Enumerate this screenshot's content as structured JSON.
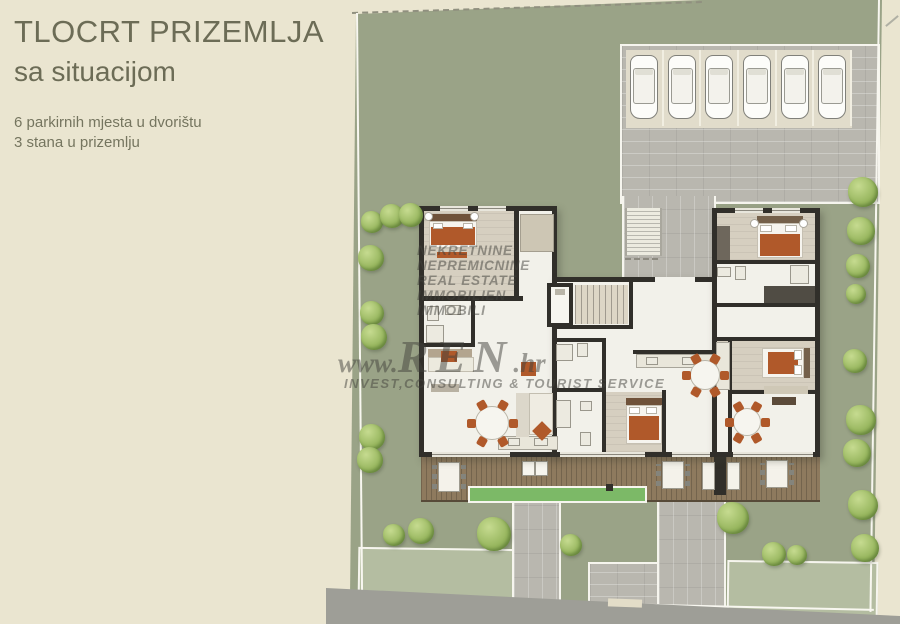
{
  "title": {
    "heading": "TLOCRT PRIZEMLJA",
    "subheading": "sa situacijom",
    "notes": [
      "6 parkirnih mjesta u dvorištu",
      "3 stana u prizemlju"
    ]
  },
  "watermark": {
    "languages": [
      "NEKRETNINE",
      "NEPREMICNINE",
      "REAL ESTATE",
      "IMMOBILIEN",
      "IMMOBILI"
    ],
    "url_prefix": "www.",
    "url_main": "REN",
    "url_suffix": ".hr",
    "tagline": "INVEST,CONSULTING & TOURIST SERVICE"
  },
  "site": {
    "parking_spaces": 6,
    "apartments_ground_floor": 3,
    "trees": [
      [
        372,
        222,
        22
      ],
      [
        392,
        216,
        24
      ],
      [
        411,
        215,
        24
      ],
      [
        371,
        258,
        26
      ],
      [
        372,
        313,
        24
      ],
      [
        374,
        337,
        26
      ],
      [
        372,
        437,
        26
      ],
      [
        370,
        460,
        26
      ],
      [
        863,
        192,
        30
      ],
      [
        861,
        231,
        28
      ],
      [
        858,
        266,
        24
      ],
      [
        856,
        294,
        20
      ],
      [
        855,
        361,
        24
      ],
      [
        861,
        420,
        30
      ],
      [
        857,
        453,
        28
      ],
      [
        394,
        535,
        22
      ],
      [
        421,
        531,
        26
      ],
      [
        494,
        534,
        34
      ],
      [
        571,
        545,
        22
      ],
      [
        733,
        518,
        32
      ],
      [
        774,
        554,
        24
      ],
      [
        797,
        555,
        20
      ],
      [
        863,
        505,
        30
      ],
      [
        865,
        548,
        28
      ]
    ]
  },
  "colors": {
    "bg": "#eae5d0",
    "title_text": "#6c6c56",
    "note_text": "#75755f",
    "site_green": "#9aa387",
    "lawn_light": "#b4bda1",
    "paver": "#b9b7af",
    "stall_bg": "#e1dccb",
    "road": "#9e9e97",
    "deck": "#8e7a5e",
    "wall": "#312f2a",
    "room": "#f2f1ea",
    "parquet": "#d6cfc0",
    "orange": "#b0592a",
    "wood_dark": "#6f523a",
    "tree_edge": "#7d9c4a",
    "bright_strip": "#7cb967",
    "car_body": "#fcfcf9",
    "watermark": "rgba(66,66,60,0.5)"
  }
}
